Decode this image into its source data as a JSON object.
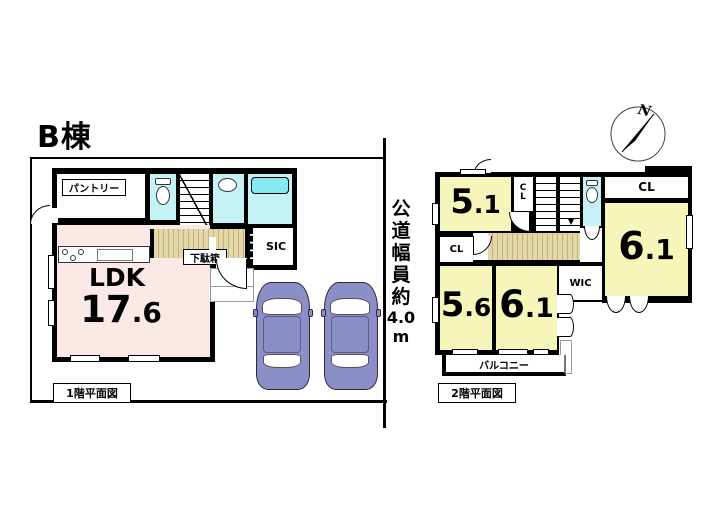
{
  "title": "B棟",
  "compass": {
    "north": "N"
  },
  "road": {
    "chars": [
      "公",
      "道",
      "幅",
      "員",
      "約",
      "4.0",
      "m"
    ]
  },
  "floor1": {
    "caption": "1階平面図",
    "ldk": {
      "name": "LDK",
      "area_int": "17",
      "area_dec": ".6"
    },
    "pantry_label": "パントリー",
    "shoe_cabinet_label": "下駄箱",
    "sic_label": "SIC"
  },
  "floor2": {
    "caption": "2階平面図",
    "stairs_arrow": "▼",
    "rooms": {
      "top_left": {
        "int": "5",
        "dec": ".1"
      },
      "right": {
        "int": "6",
        "dec": ".1"
      },
      "bottom_left": {
        "int": "5",
        "dec": ".6"
      },
      "bottom_mid": {
        "int": "6",
        "dec": ".1"
      }
    },
    "cl_vertical": "CL",
    "cl_top_right": "CL",
    "cl_left": "CL",
    "wic_label": "WIC",
    "balcony_label": "バルコニー"
  },
  "colors": {
    "wall": "#000000",
    "ldk_pink": "#fbe9e8",
    "room_yellow": "#f6f5ba",
    "wet_cyan": "#c4f2f5",
    "fixture_cyan": "#86e9f1",
    "wood_light": "#e4d7a9",
    "wood_dark": "#c2b17b",
    "car_body": "#8c8ec8"
  }
}
